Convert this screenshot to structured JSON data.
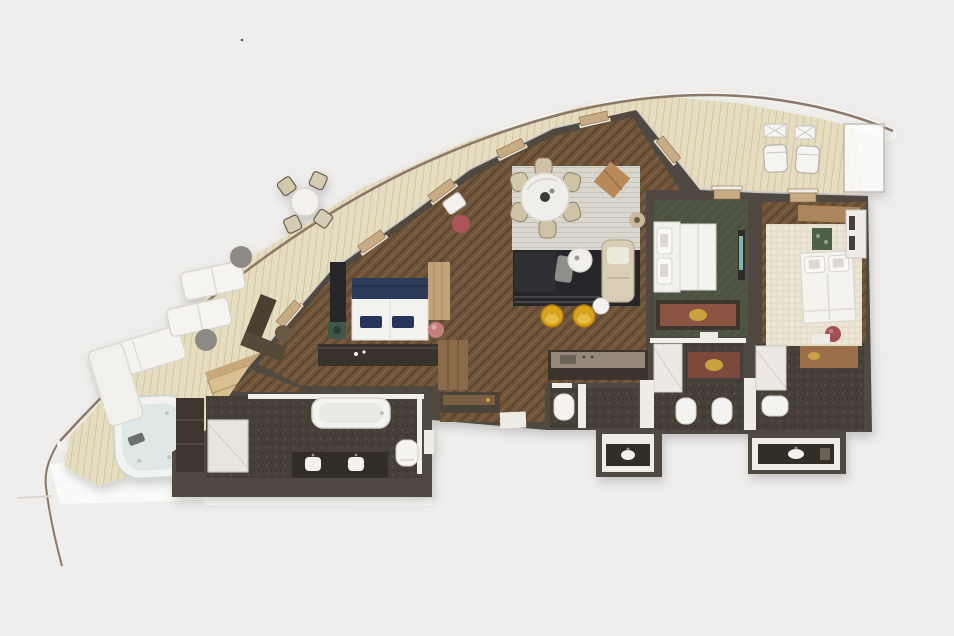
{
  "meta": {
    "description": "Top-down 3D rendered floor plan of a curved luxury suite with wraparound teak terrace, hot tub, three bedrooms, bathrooms and living-dining area",
    "width": 954,
    "height": 636
  },
  "palette": {
    "background": "#efeeec",
    "hull": "#8c7867",
    "deck": "#e6dcc0",
    "deck_band": "#f9f8f4",
    "apron": "#fafaf8",
    "wall": "#4f4a43",
    "wall_dark": "#3b362f",
    "wood": "#6d5238",
    "olive": "#4d5243",
    "bath": "#474039",
    "rug_gray": "#dad7cf",
    "rug_black": "#25262a",
    "rug_woven": "#ece6d4",
    "white": "#f4f3ef",
    "navy": "#2c3a5c",
    "yellow": "#d7a31f",
    "beige": "#d3c7ac",
    "tan_door": "#c9ab83",
    "wood_light": "#d9bf92",
    "green_stand": "#41584a",
    "pink": "#c77f82",
    "maroon": "#9f5156",
    "water": "#dfe8e6",
    "teal": "#7fb5ac",
    "gold": "#c9a23f",
    "metal": "#96897b",
    "niche": "#8a5243",
    "glass": "#ffffff"
  },
  "terrace": {
    "items": [
      "railing",
      "hot-tub",
      "wood-step-caddy",
      "daybed",
      "sun-lounger",
      "sun-lounger",
      "side-table",
      "side-table",
      "outdoor-round-table",
      "outdoor-chair",
      "outdoor-chair",
      "outdoor-chair",
      "outdoor-chair",
      "lounge-chair",
      "lounge-chair",
      "folding-table",
      "folding-table",
      "glass-divider"
    ]
  },
  "suite": {
    "rooms": [
      {
        "name": "master-bedroom",
        "furniture": [
          "double-bed",
          "navy-pillows",
          "nightstand",
          "table-lamp",
          "console-dresser",
          "desk",
          "desk-chair",
          "pouf",
          "armchair",
          "wood-panel"
        ]
      },
      {
        "name": "dining-area",
        "furniture": [
          "round-dining-table",
          "dining-chair-x6",
          "striped-rug",
          "leather-ottoman",
          "lamp-table"
        ]
      },
      {
        "name": "living-area",
        "furniture": [
          "sofa",
          "coffee-table",
          "chaise-lounge",
          "tub-chair-x2",
          "side-table",
          "throw-blanket"
        ]
      },
      {
        "name": "galley",
        "furniture": [
          "counter",
          "sink"
        ]
      },
      {
        "name": "master-bathroom",
        "furniture": [
          "bathtub",
          "shower",
          "double-vanity",
          "toilet",
          "wardrobe"
        ]
      },
      {
        "name": "walk-in-closet",
        "furniture": [
          "shelving",
          "credenza"
        ]
      },
      {
        "name": "bedroom-2",
        "furniture": [
          "double-bed",
          "wall-tv",
          "decor-niche"
        ]
      },
      {
        "name": "bedroom-3",
        "furniture": [
          "double-bed",
          "desk",
          "planter",
          "wardrobe",
          "bench",
          "ball-lamp"
        ]
      },
      {
        "name": "bathroom-2",
        "furniture": [
          "toilet",
          "toilet",
          "shower",
          "luggage-niche",
          "vanity-pod"
        ]
      },
      {
        "name": "bathroom-3",
        "furniture": [
          "toilet",
          "shower",
          "luggage-niche",
          "vanity-pod"
        ]
      },
      {
        "name": "guest-bathroom",
        "furniture": [
          "toilet",
          "vanity-pod"
        ]
      }
    ]
  }
}
